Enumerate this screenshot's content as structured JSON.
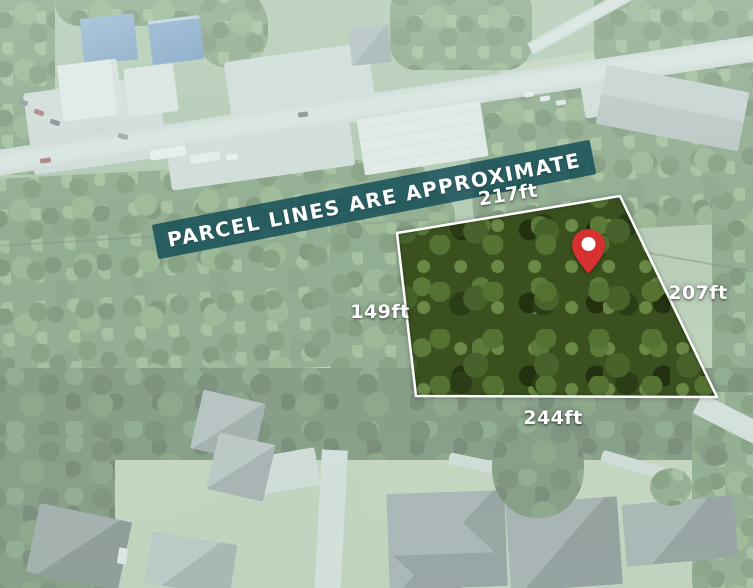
{
  "banner": {
    "text": "PARCEL LINES ARE APPROXIMATE",
    "background_color": "#114c55",
    "text_color": "#ffffff"
  },
  "parcel": {
    "outline_color": "#ffffff",
    "pin_color": "#d6302f",
    "measurements": {
      "top": "217ft",
      "right": "207ft",
      "left": "149ft",
      "bottom": "244ft"
    }
  }
}
